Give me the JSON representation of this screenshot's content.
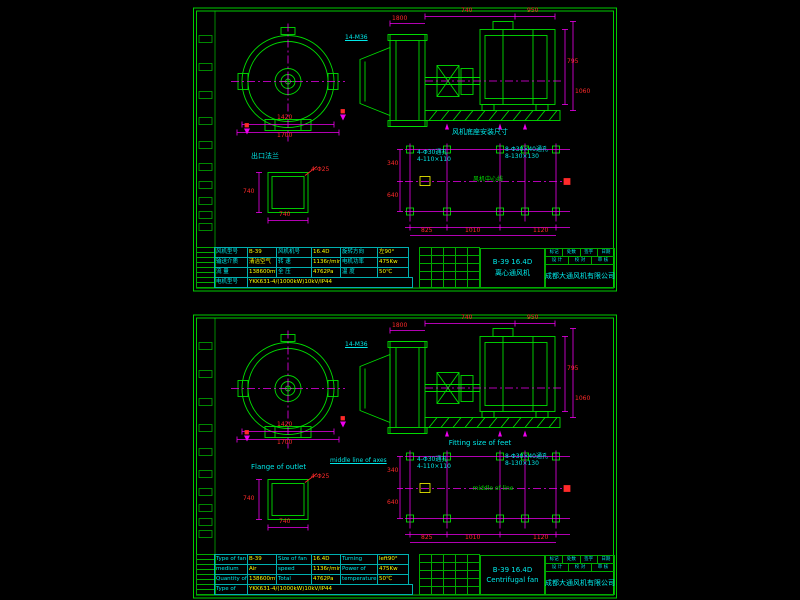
{
  "colors": {
    "background": "#000000",
    "line_green": "#00dd00",
    "centerline_magenta": "#ee00ee",
    "dim_red": "#ff2a2a",
    "label_cyan": "#00e8e8",
    "value_yellow": "#ffff00"
  },
  "dims": {
    "front1": "1420",
    "front2": "1700",
    "side_top1": "740",
    "side_top2": "950",
    "side_left": "1800",
    "side_right1": "795",
    "side_right2": "1060",
    "flange_w": "740",
    "flange_h": "740",
    "plan_b1": "825",
    "plan_b2": "1010",
    "plan_b3": "1120",
    "plan_l1": "340",
    "plan_l2": "640"
  },
  "notes": {
    "bolt": "14-M36",
    "flange": "4-Φ25",
    "left1": "4-Φ30通孔",
    "left2": "4-110×110",
    "right1": "8-Φ30×40通孔",
    "right2": "8-130×130"
  },
  "frame": {
    "company": "成都大通风机有限公司",
    "head_cells": [
      "标记",
      "处数",
      "签字",
      "日期"
    ],
    "sign_cells": [
      "设 计",
      "校 对",
      "审 核"
    ]
  },
  "sheets": [
    {
      "name": "chinese-sheet",
      "labels": {
        "outlet": "出口法兰",
        "plan_title": "风机底座安装尺寸",
        "plan_center": "风机中心线",
        "plan_axis": ""
      },
      "title": {
        "model": "B-39 16.4D",
        "name": "离心通风机"
      },
      "spec_rows": [
        [
          "风机型号",
          "B-39",
          "风机机号",
          "16.4D",
          "旋转方向",
          "左90°"
        ],
        [
          "输送介质",
          "清洁空气",
          "转  速",
          "1136r/min",
          "电机功率",
          "475Kw"
        ],
        [
          "流  量",
          "138600m³/h",
          "全  压",
          "4762Pa",
          "温  度",
          "50℃"
        ],
        [
          "电机型号",
          "YKK631-4/(1000kW)10kV/IP44"
        ]
      ]
    },
    {
      "name": "english-sheet",
      "labels": {
        "outlet": "Flange of outlet",
        "plan_title": "Fitting size of feet",
        "plan_center": "middle of line",
        "plan_axis": "middle line of axes"
      },
      "title": {
        "model": "B-39 16.4D",
        "name": "Centrifugal fan"
      },
      "spec_rows": [
        [
          "Type of fan",
          "B-39",
          "Size of fan",
          "16.4D",
          "Turning direction",
          "left90°"
        ],
        [
          "medium",
          "Air",
          "speed",
          "1136r/min",
          "Power of motor",
          "475Kw"
        ],
        [
          "Quantity of flow",
          "138600m³/h",
          "Total pressure",
          "4762Pa",
          "temperature",
          "50℃"
        ],
        [
          "Type of motor",
          "YKK631-4/(1000kW)10kV/IP44"
        ]
      ]
    }
  ]
}
